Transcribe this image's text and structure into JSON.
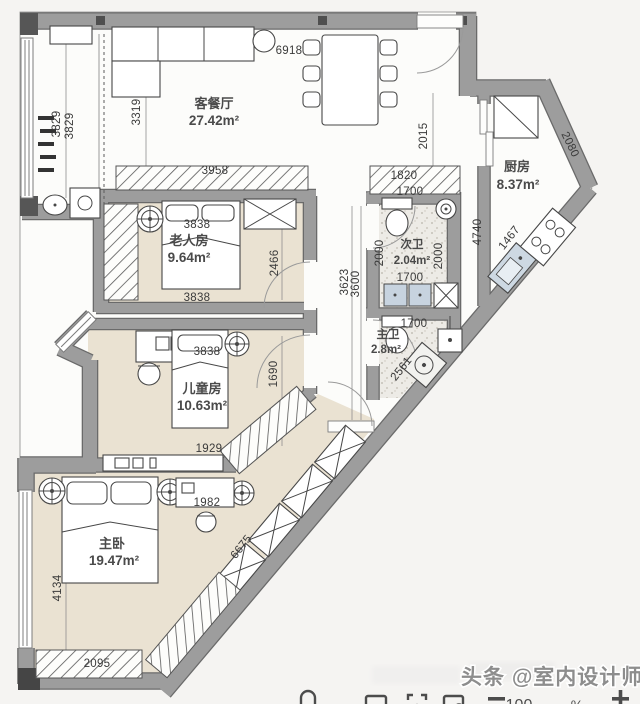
{
  "rooms": {
    "living": {
      "name": "客餐厅",
      "area": "27.42m²"
    },
    "kitchen": {
      "name": "厨房",
      "area": "8.37m²"
    },
    "elder": {
      "name": "老人房",
      "area": "9.64m²"
    },
    "kids": {
      "name": "儿童房",
      "area": "10.63m²"
    },
    "master": {
      "name": "主卧",
      "area": "19.47m²"
    },
    "bath2": {
      "name": "次卫",
      "area": "2.04m²"
    },
    "bath1": {
      "name": "主卫",
      "area": "2.8m²"
    }
  },
  "dims": {
    "top_entry": "6918",
    "balcony_a": "3829",
    "balcony_b": "3829",
    "living_depth": "3319",
    "tv_cabinet": "3958",
    "elder_top": "3838",
    "elder_bottom": "3838",
    "elder_depth": "2466",
    "hall_a": "3623",
    "hall_b": "3600",
    "foyer": "2015",
    "shoe_cabinet": "1820",
    "kitchen_ne": "2080",
    "kitchen_left": "4740",
    "kitchen_counter": "1467",
    "bath2_top": "1700",
    "bath2_left": "2000",
    "bath2_right": "2000",
    "bath2_bottom": "1700",
    "bath1_top": "1700",
    "bath1_diag": "2561",
    "kids_top": "3838",
    "kids_depth": "1690",
    "kids_bottom": "1929",
    "master_desk": "1982",
    "master_left": "4134",
    "master_diag": "6675",
    "master_bottom": "2095"
  },
  "watermark": {
    "text": "头条 @室内设计师苏哥"
  },
  "toolbar": {
    "zoom_value": "100",
    "percent_sign": "%"
  },
  "colors": {
    "wall": "#9d9d9d",
    "wall_edge": "#6a6a6a",
    "floor_beige": "#eae2d2",
    "accent_sink": "#c7d3df"
  }
}
